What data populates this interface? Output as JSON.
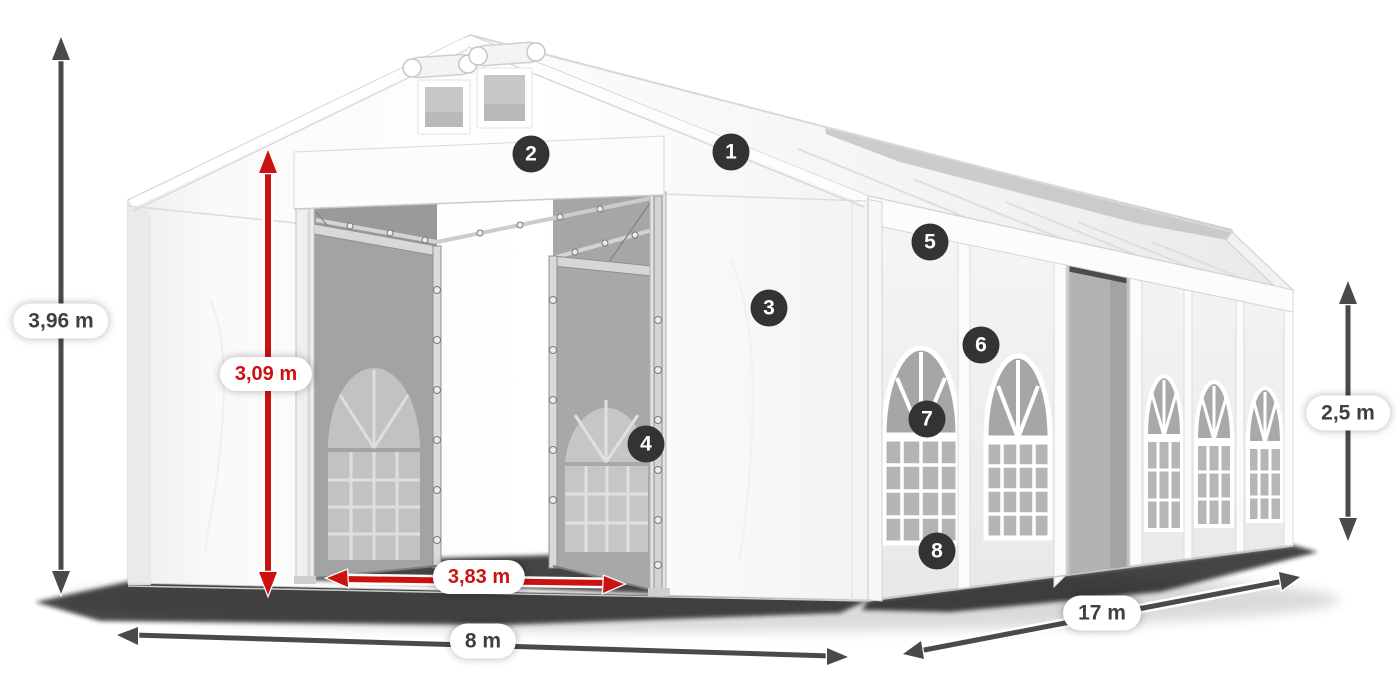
{
  "dimensions": {
    "total_height": "3,96 m",
    "entrance_height": "3,09 m",
    "entrance_width": "3,83 m",
    "front_width": "8 m",
    "side_length": "17 m",
    "side_wall_height": "2,5 m"
  },
  "part_markers": [
    {
      "number": "1"
    },
    {
      "number": "2"
    },
    {
      "number": "3"
    },
    {
      "number": "4"
    },
    {
      "number": "5"
    },
    {
      "number": "6"
    },
    {
      "number": "7"
    },
    {
      "number": "8"
    }
  ],
  "colors": {
    "background": "#ffffff",
    "accent_red": "#cc1111",
    "arrow_gray": "#4a4a4a",
    "marker_bg": "#333333",
    "label_text": "#3f3f3f",
    "pill_bg": "#ffffff"
  }
}
